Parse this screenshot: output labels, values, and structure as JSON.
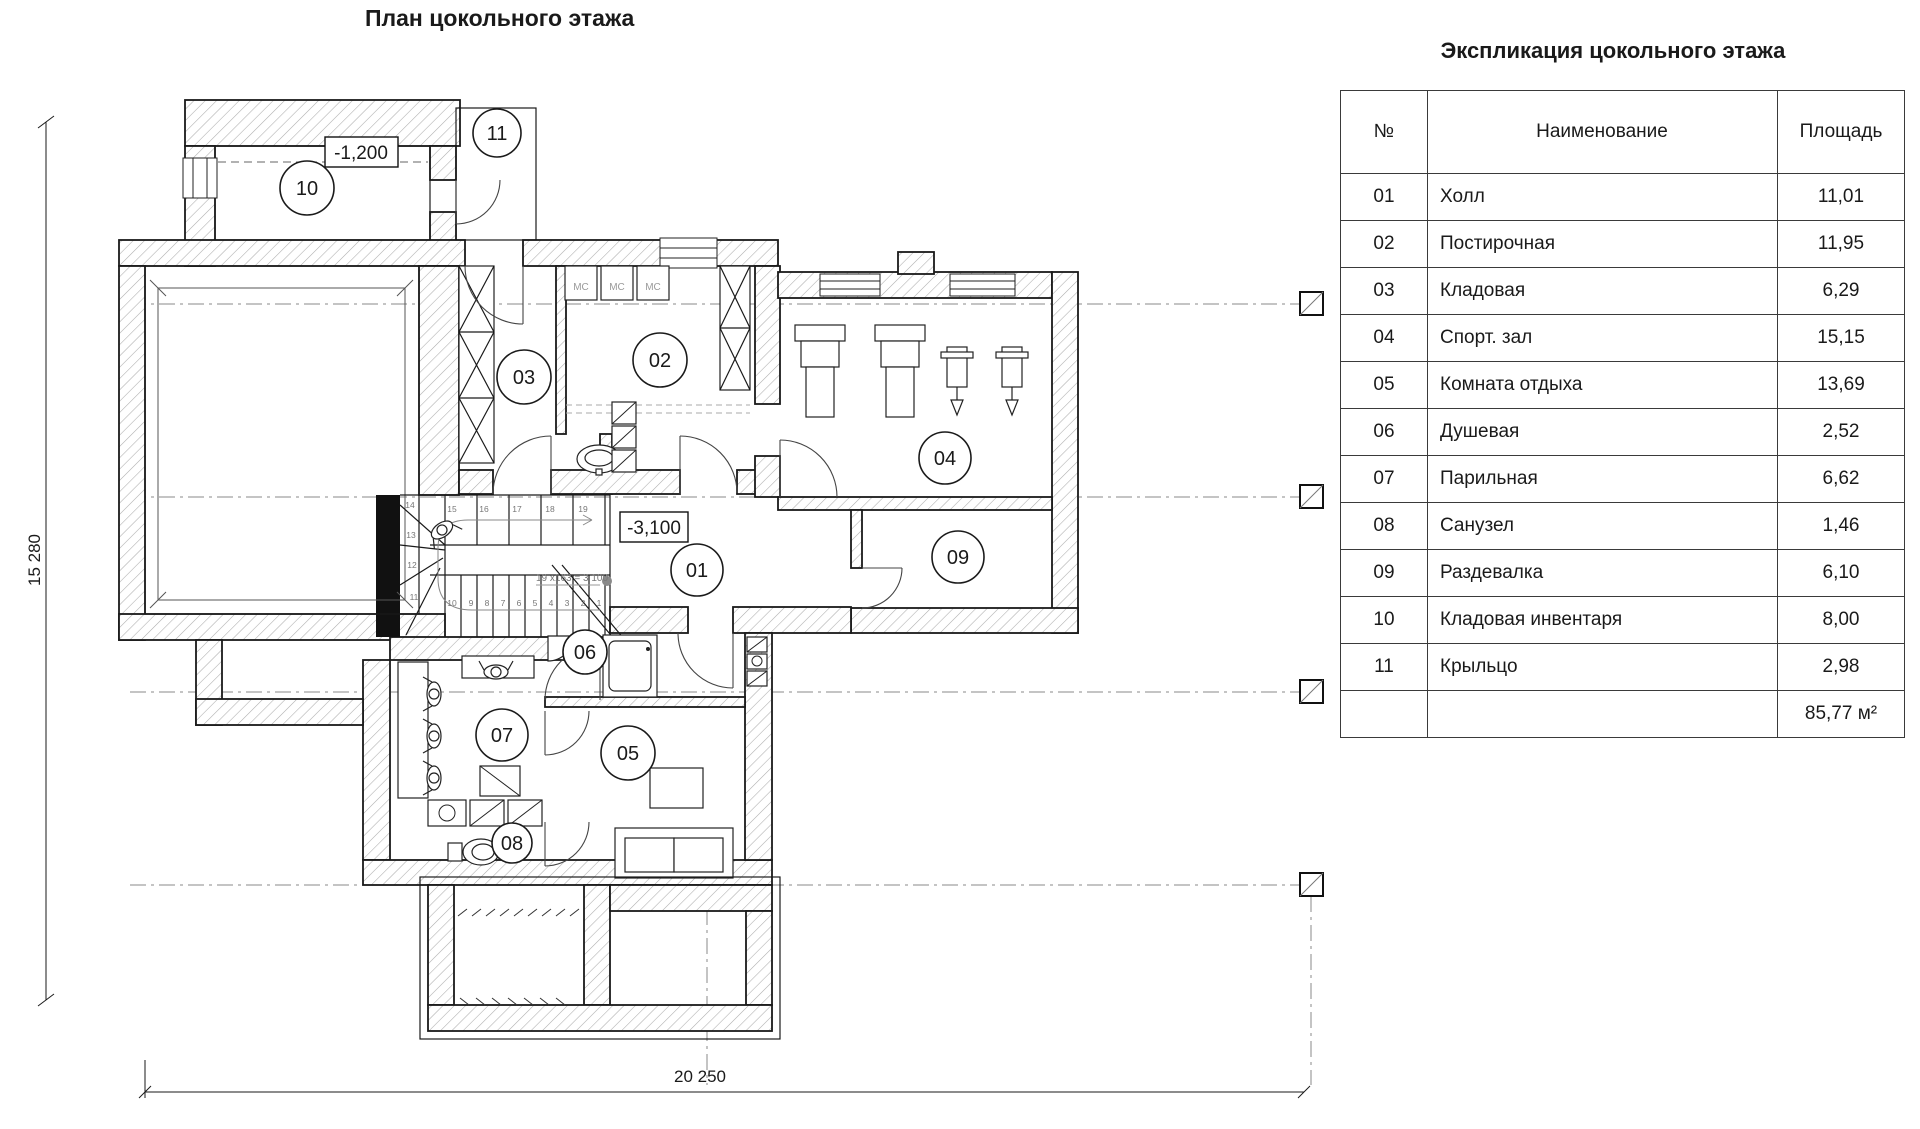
{
  "plan": {
    "title": "План цокольного этажа",
    "elevation_upper": "-1,200",
    "elevation_lower": "-3,100",
    "dim_left": "15 280",
    "dim_bottom": "20 250",
    "stair_note": "19 x163 = 3 100",
    "appliance_label": "МС",
    "appliance_positions": [
      {
        "x": 581,
        "y": 290
      },
      {
        "x": 617,
        "y": 290
      },
      {
        "x": 653,
        "y": 290
      }
    ],
    "room_markers": [
      {
        "number": "01",
        "x": 697,
        "y": 570,
        "r": 26
      },
      {
        "number": "02",
        "x": 660,
        "y": 360,
        "r": 27
      },
      {
        "number": "03",
        "x": 524,
        "y": 377,
        "r": 27
      },
      {
        "number": "04",
        "x": 945,
        "y": 458,
        "r": 26
      },
      {
        "number": "05",
        "x": 628,
        "y": 753,
        "r": 27
      },
      {
        "number": "06",
        "x": 585,
        "y": 652,
        "r": 22
      },
      {
        "number": "07",
        "x": 502,
        "y": 735,
        "r": 26
      },
      {
        "number": "08",
        "x": 512,
        "y": 843,
        "r": 20
      },
      {
        "number": "09",
        "x": 958,
        "y": 557,
        "r": 26
      },
      {
        "number": "10",
        "x": 307,
        "y": 188,
        "r": 27
      },
      {
        "number": "11",
        "x": 497,
        "y": 133,
        "r": 24
      }
    ],
    "step_numbers": [
      {
        "t": "14",
        "x": 410,
        "y": 508
      },
      {
        "t": "13",
        "x": 411,
        "y": 538
      },
      {
        "t": "12",
        "x": 412,
        "y": 568
      },
      {
        "t": "11",
        "x": 414,
        "y": 600
      },
      {
        "t": "10",
        "x": 452,
        "y": 606
      },
      {
        "t": "9",
        "x": 471,
        "y": 606
      },
      {
        "t": "8",
        "x": 487,
        "y": 606
      },
      {
        "t": "7",
        "x": 503,
        "y": 606
      },
      {
        "t": "6",
        "x": 519,
        "y": 606
      },
      {
        "t": "5",
        "x": 535,
        "y": 606
      },
      {
        "t": "4",
        "x": 551,
        "y": 606
      },
      {
        "t": "3",
        "x": 567,
        "y": 606
      },
      {
        "t": "2",
        "x": 583,
        "y": 606
      },
      {
        "t": "1",
        "x": 599,
        "y": 606
      },
      {
        "t": "15",
        "x": 452,
        "y": 512
      },
      {
        "t": "16",
        "x": 484,
        "y": 512
      },
      {
        "t": "17",
        "x": 517,
        "y": 512
      },
      {
        "t": "18",
        "x": 550,
        "y": 512
      },
      {
        "t": "19",
        "x": 583,
        "y": 512
      }
    ]
  },
  "legend_table": {
    "title": "Экспликация цокольного этажа",
    "columns": {
      "num": "№",
      "name": "Наименование",
      "area": "Площадь"
    },
    "rows": [
      {
        "num": "01",
        "name": "Холл",
        "area": "11,01"
      },
      {
        "num": "02",
        "name": "Постирочная",
        "area": "11,95"
      },
      {
        "num": "03",
        "name": "Кладовая",
        "area": "6,29"
      },
      {
        "num": "04",
        "name": "Спорт. зал",
        "area": "15,15"
      },
      {
        "num": "05",
        "name": "Комната отдыха",
        "area": "13,69"
      },
      {
        "num": "06",
        "name": "Душевая",
        "area": "2,52"
      },
      {
        "num": "07",
        "name": "Парильная",
        "area": "6,62"
      },
      {
        "num": "08",
        "name": "Санузел",
        "area": "1,46"
      },
      {
        "num": "09",
        "name": "Раздевалка",
        "area": "6,10"
      },
      {
        "num": "10",
        "name": "Кладовая инвентаря",
        "area": "8,00"
      },
      {
        "num": "11",
        "name": "Крыльцо",
        "area": "2,98"
      }
    ],
    "total_area": "85,77 м²"
  }
}
